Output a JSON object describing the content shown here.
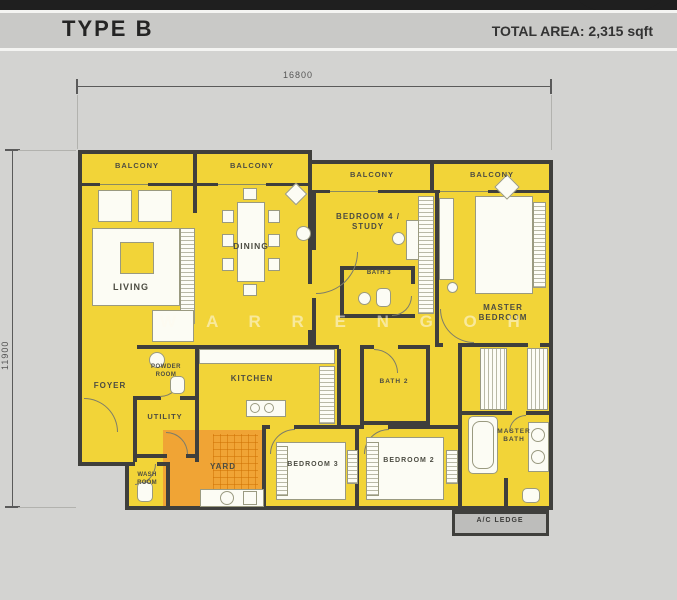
{
  "header": {
    "title": "TYPE B",
    "total_area": "TOTAL AREA: 2,315 sqft"
  },
  "dimensions": {
    "top_width": "16800",
    "left_height": "11900"
  },
  "watermark": "W A R R E N  G O H",
  "colors": {
    "floor_yellow": "#f2d438",
    "yard_orange": "#f0a435",
    "wall_dark": "#3f3f3c",
    "background_gray": "#d3d3d1"
  },
  "rooms": {
    "balcony1": "BALCONY",
    "balcony2": "BALCONY",
    "balcony3": "BALCONY",
    "balcony4": "BALCONY",
    "living": "LIVING",
    "dining": "DINING",
    "bedroom4_study": "BEDROOM 4 /\nSTUDY",
    "bath3": "BATH 3",
    "master_bedroom": "MASTER\nBEDROOM",
    "foyer": "FOYER",
    "powder_room": "POWDER\nROOM",
    "kitchen": "KITCHEN",
    "utility": "UTILITY",
    "yard": "YARD",
    "wash_room": "WASH\nROOM",
    "bath2": "BATH 2",
    "bedroom3": "BEDROOM 3",
    "bedroom2": "BEDROOM 2",
    "master_bath": "MASTER\nBATH",
    "ac_ledge": "A/C LEDGE"
  }
}
